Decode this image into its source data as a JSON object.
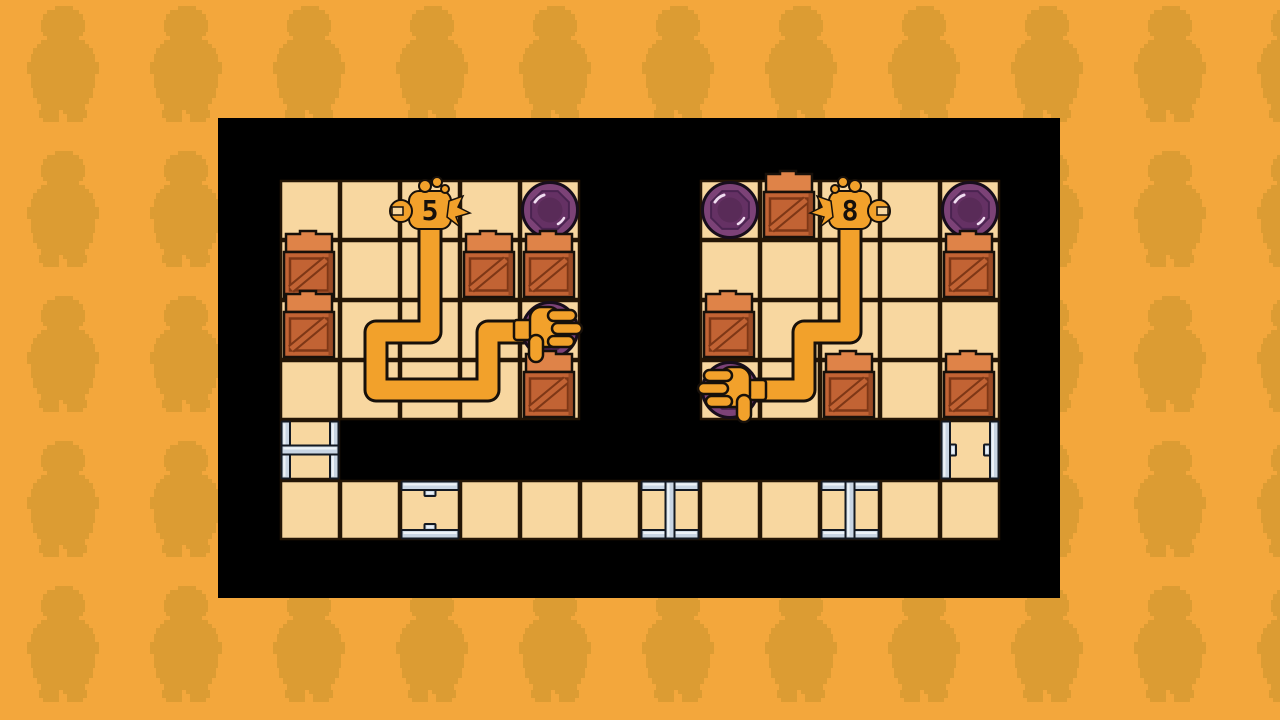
{
  "app": {
    "name": "grabber-arm-puzzle",
    "screen": "level-board"
  },
  "palette": {
    "background": "#F3A73C",
    "background_figure": "#DC9C33",
    "board_bg": "#000000",
    "tile_fill": "#F8D7A0",
    "tile_line": "#241505",
    "arm": "#F2A12B",
    "outline": "#17100A",
    "crate_top": "#DF8348",
    "crate_front": "#C26334",
    "crate_side": "#9A4A24",
    "crate_line": "#7E3716",
    "disc_outer": "#7C4277",
    "disc_mid": "#653164",
    "disc_core": "#592B58",
    "disc_shine": "#EFDcF0",
    "metal": "#C9D5E3",
    "metal_hi": "#EDF2F7",
    "metal_line": "#141922"
  },
  "background": {
    "offset_x": 27,
    "offset_y": 6,
    "spacing_x": 123,
    "spacing_y": 145
  },
  "board": {
    "x": 218,
    "y": 118,
    "width": 842,
    "height": 480
  },
  "grid": {
    "origin_x": 62,
    "origin_y": 62,
    "cell": 60,
    "cols": 12,
    "rows": 6
  },
  "floors": [
    [
      0,
      0
    ],
    [
      1,
      0
    ],
    [
      2,
      0
    ],
    [
      3,
      0
    ],
    [
      4,
      0
    ],
    [
      7,
      0
    ],
    [
      8,
      0
    ],
    [
      9,
      0
    ],
    [
      10,
      0
    ],
    [
      11,
      0
    ],
    [
      0,
      1
    ],
    [
      1,
      1
    ],
    [
      2,
      1
    ],
    [
      3,
      1
    ],
    [
      4,
      1
    ],
    [
      7,
      1
    ],
    [
      8,
      1
    ],
    [
      9,
      1
    ],
    [
      10,
      1
    ],
    [
      11,
      1
    ],
    [
      0,
      2
    ],
    [
      1,
      2
    ],
    [
      2,
      2
    ],
    [
      3,
      2
    ],
    [
      4,
      2
    ],
    [
      7,
      2
    ],
    [
      8,
      2
    ],
    [
      9,
      2
    ],
    [
      10,
      2
    ],
    [
      11,
      2
    ],
    [
      0,
      3
    ],
    [
      1,
      3
    ],
    [
      2,
      3
    ],
    [
      3,
      3
    ],
    [
      4,
      3
    ],
    [
      7,
      3
    ],
    [
      8,
      3
    ],
    [
      9,
      3
    ],
    [
      10,
      3
    ],
    [
      11,
      3
    ],
    [
      0,
      4
    ],
    [
      11,
      4
    ],
    [
      0,
      5
    ],
    [
      1,
      5
    ],
    [
      2,
      5
    ],
    [
      3,
      5
    ],
    [
      4,
      5
    ],
    [
      5,
      5
    ],
    [
      6,
      5
    ],
    [
      7,
      5
    ],
    [
      8,
      5
    ],
    [
      9,
      5
    ],
    [
      10,
      5
    ],
    [
      11,
      5
    ]
  ],
  "doors": [
    {
      "c": 0,
      "r": 4,
      "orientation": "vertical",
      "state": "closed"
    },
    {
      "c": 11,
      "r": 4,
      "orientation": "vertical",
      "state": "open"
    },
    {
      "c": 2,
      "r": 5,
      "orientation": "horizontal",
      "state": "open"
    },
    {
      "c": 6,
      "r": 5,
      "orientation": "horizontal",
      "state": "closed"
    },
    {
      "c": 9,
      "r": 5,
      "orientation": "horizontal",
      "state": "closed"
    }
  ],
  "crates": [
    [
      0,
      1
    ],
    [
      3,
      1
    ],
    [
      4,
      1
    ],
    [
      0,
      2
    ],
    [
      4,
      3
    ],
    [
      8,
      0
    ],
    [
      11,
      1
    ],
    [
      7,
      2
    ],
    [
      9,
      3
    ],
    [
      11,
      3
    ]
  ],
  "free_discs": [
    [
      4,
      0
    ],
    [
      7,
      0
    ],
    [
      11,
      0
    ]
  ],
  "arms": [
    {
      "label": "5",
      "dispenser_cell": {
        "c": 2,
        "r": 0
      },
      "claw_side": "left",
      "path": [
        [
          212,
          97
        ],
        [
          212,
          214
        ],
        [
          158,
          214
        ],
        [
          158,
          272
        ],
        [
          270,
          272
        ],
        [
          270,
          214
        ],
        [
          316,
          214
        ]
      ],
      "hand": {
        "disc_cell": {
          "c": 4,
          "r": 2
        },
        "dir": "east"
      }
    },
    {
      "label": "8",
      "dispenser_cell": {
        "c": 9,
        "r": 0
      },
      "claw_side": "right",
      "path": [
        [
          632,
          97
        ],
        [
          632,
          214
        ],
        [
          586,
          214
        ],
        [
          586,
          272
        ],
        [
          534,
          272
        ]
      ],
      "hand": {
        "disc_cell": {
          "c": 7,
          "r": 3
        },
        "dir": "west"
      }
    }
  ]
}
